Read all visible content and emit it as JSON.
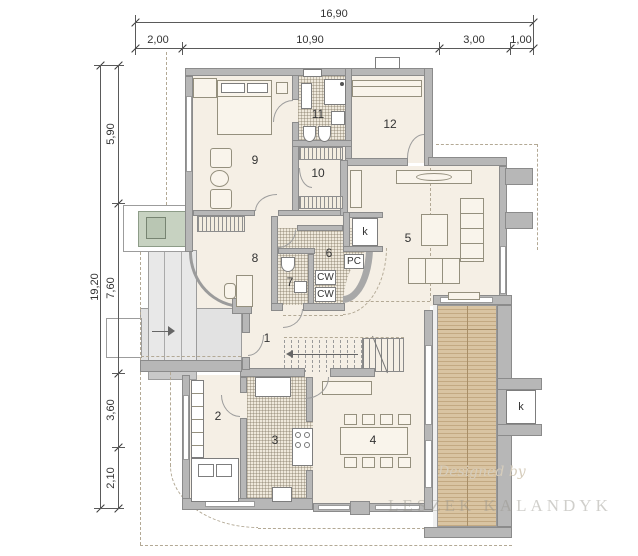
{
  "dimensions": {
    "top": {
      "total": "16,90",
      "seg1": "2,00",
      "seg2": "10,90",
      "seg3": "3,00",
      "seg4": "1,00"
    },
    "left": {
      "total": "19,20",
      "seg1": "5,90",
      "seg2": "7,60",
      "seg3": "3,60",
      "seg4": "2,10"
    }
  },
  "rooms": {
    "r1": "1",
    "r2": "2",
    "r3": "3",
    "r4": "4",
    "r5": "5",
    "r6": "6",
    "r7": "7",
    "r8": "8",
    "r9": "9",
    "r10": "10",
    "r11": "11",
    "r12": "12"
  },
  "fixtures": {
    "fireplace": "k",
    "pc": "PC",
    "cw_top": "CW",
    "cw_bottom": "CW",
    "chimney": "k"
  },
  "watermark": {
    "script": "Designed by",
    "name": "LESZEK KALANDYK"
  }
}
